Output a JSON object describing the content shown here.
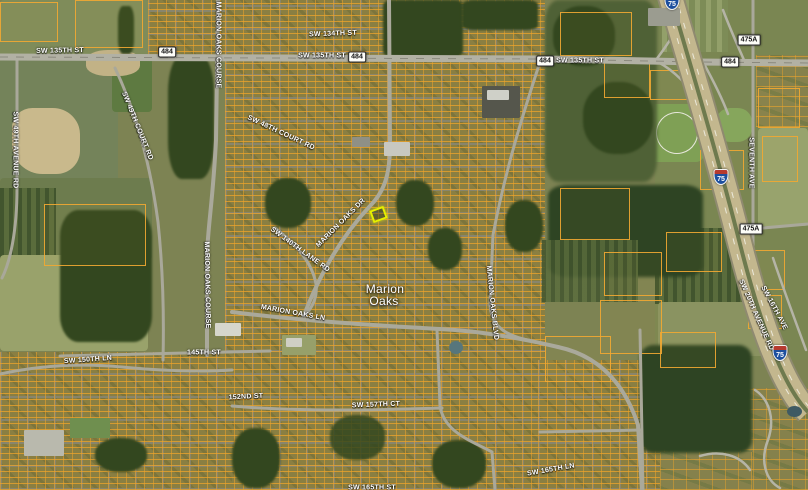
{
  "map": {
    "view": "satellite",
    "place": {
      "line1": "Marion",
      "line2": "Oaks"
    },
    "labels": [
      {
        "t": "SW 135TH ST",
        "x": 60,
        "y": 51,
        "r": -1,
        "n": "road-label-sw-135th-st-west"
      },
      {
        "t": "SW 135TH ST",
        "x": 322,
        "y": 56,
        "r": 0,
        "n": "road-label-sw-135th-st-center"
      },
      {
        "t": "SW 135TH ST",
        "x": 580,
        "y": 61,
        "r": 0,
        "n": "road-label-sw-135th-st-east"
      },
      {
        "t": "SW 134TH ST",
        "x": 333,
        "y": 34,
        "r": -2,
        "n": "road-label-sw-134th-st"
      },
      {
        "t": "SW 49TH AVENUE RD",
        "x": 15,
        "y": 150,
        "r": 90,
        "n": "road-label-sw-49th-avenue-rd"
      },
      {
        "t": "SW 49TH COURT RD",
        "x": 137,
        "y": 126,
        "r": 68,
        "n": "road-label-sw-49th-court-rd"
      },
      {
        "t": "SW 48TH COURT RD",
        "x": 281,
        "y": 133,
        "r": 25,
        "n": "road-label-sw-48th-court-rd"
      },
      {
        "t": "MARION OAKS COURSE",
        "x": 218,
        "y": 45,
        "r": 90,
        "n": "road-label-marion-oaks-course-north"
      },
      {
        "t": "MARION OAKS COURSE",
        "x": 207,
        "y": 285,
        "r": 89,
        "n": "road-label-marion-oaks-course-south"
      },
      {
        "t": "MARION OAKS DR",
        "x": 341,
        "y": 223,
        "r": -45,
        "n": "road-label-marion-oaks-dr"
      },
      {
        "t": "SW 140TH LANE RD",
        "x": 300,
        "y": 250,
        "r": 36,
        "n": "road-label-sw-140th-lane-rd"
      },
      {
        "t": "MARION OAKS LN",
        "x": 293,
        "y": 313,
        "r": 10,
        "n": "road-label-marion-oaks-ln"
      },
      {
        "t": "MARION OAKS BLVD",
        "x": 492,
        "y": 303,
        "r": 84,
        "n": "road-label-marion-oaks-blvd"
      },
      {
        "t": "145TH ST",
        "x": 204,
        "y": 353,
        "r": 0,
        "n": "road-label-145th-st"
      },
      {
        "t": "SW 150TH LN",
        "x": 88,
        "y": 360,
        "r": -4,
        "n": "road-label-sw-150th-ln"
      },
      {
        "t": "152ND ST",
        "x": 246,
        "y": 397,
        "r": -3,
        "n": "road-label-152nd-st"
      },
      {
        "t": "SW 157TH CT",
        "x": 376,
        "y": 405,
        "r": -2,
        "n": "road-label-sw-157th-ct"
      },
      {
        "t": "SW 165TH LN",
        "x": 551,
        "y": 470,
        "r": -10,
        "n": "road-label-sw-165th-ln"
      },
      {
        "t": "SW 165TH ST",
        "x": 372,
        "y": 488,
        "r": 0,
        "n": "road-label-sw-165th-st"
      },
      {
        "t": "SEVENTH AVE",
        "x": 751,
        "y": 163,
        "r": 90,
        "n": "road-label-seventh-ave"
      },
      {
        "t": "SW 20TH AVENUE RD",
        "x": 756,
        "y": 315,
        "r": 66,
        "n": "road-label-sw-20th-avenue-rd"
      },
      {
        "t": "SW 16TH AVE",
        "x": 774,
        "y": 308,
        "r": 62,
        "n": "road-label-sw-16th-ave"
      }
    ],
    "place_labels": [
      {
        "t": "Marion",
        "x": 385,
        "y": 289,
        "r": 0,
        "n": "place-label-marion"
      },
      {
        "t": "Oaks",
        "x": 384,
        "y": 301,
        "r": 0,
        "n": "place-label-oaks"
      }
    ],
    "shields": [
      {
        "kind": "route",
        "t": "484",
        "x": 167,
        "y": 52,
        "n": "route-shield-484-1"
      },
      {
        "kind": "route",
        "t": "484",
        "x": 357,
        "y": 57,
        "n": "route-shield-484-2"
      },
      {
        "kind": "route",
        "t": "484",
        "x": 545,
        "y": 61,
        "n": "route-shield-484-3"
      },
      {
        "kind": "route",
        "t": "484",
        "x": 730,
        "y": 62,
        "n": "route-shield-484-4"
      },
      {
        "kind": "route-rect",
        "t": "475A",
        "x": 749,
        "y": 40,
        "n": "route-shield-475a-north"
      },
      {
        "kind": "route-rect",
        "t": "475A",
        "x": 751,
        "y": 229,
        "n": "route-shield-475a-south"
      },
      {
        "kind": "interstate",
        "t": "75",
        "x": 721,
        "y": 177,
        "n": "interstate-shield-75-north"
      },
      {
        "kind": "interstate",
        "t": "75",
        "x": 780,
        "y": 353,
        "n": "interstate-shield-75-south"
      },
      {
        "kind": "interstate",
        "t": "75",
        "x": 672,
        "y": 2,
        "n": "interstate-shield-75-top-edge"
      }
    ],
    "highlight_parcel": {
      "x": 371,
      "y": 208,
      "w": 15,
      "h": 13,
      "r": -20
    },
    "colors": {
      "parcel_line": "#eea42a",
      "suburb_base": "#8a7f42",
      "forest": "#33471f",
      "road_gray": "#a9a89a",
      "highway_tan": "#c3b78e",
      "highlight_yellow": "#e6f000",
      "interstate_blue": "#1d4f9e",
      "interstate_red": "#b63a2f",
      "shield_white": "#fdfdf8"
    }
  }
}
